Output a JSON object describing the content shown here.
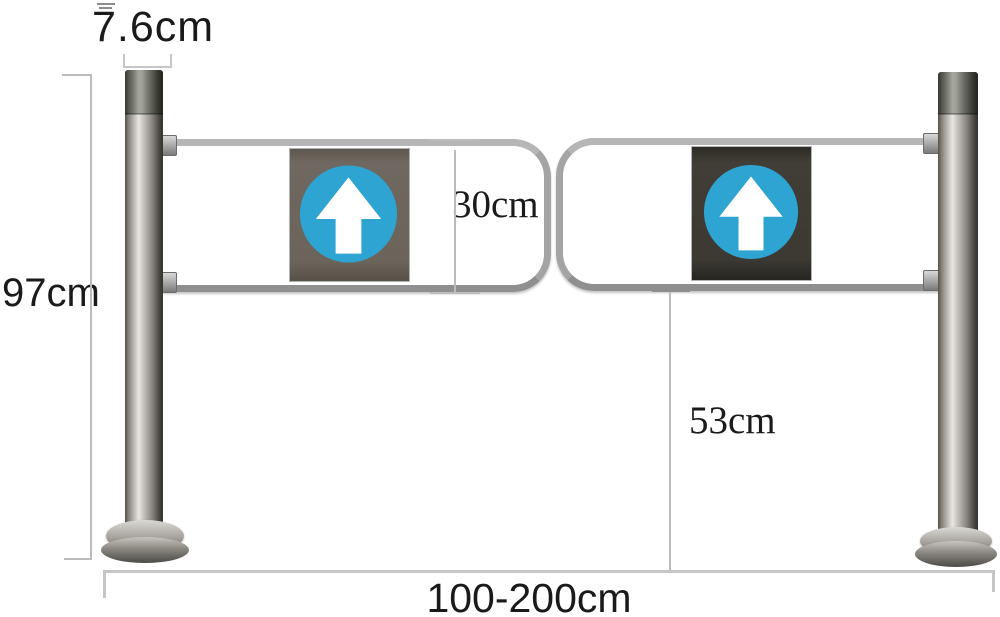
{
  "scene": {
    "description": "Stainless steel supermarket swing gate barrier with two round posts, two tubular swing arms and blue up-arrow sign panels, annotated with dimension lines",
    "background": "#ffffff"
  },
  "dimensions": {
    "post_diameter": "7.6cm",
    "overall_height": "97cm",
    "gate_panel_height": "30cm",
    "ground_clearance": "53cm",
    "width_range": "100-200cm"
  },
  "signs": {
    "left": {
      "icon": "up-arrow-icon",
      "panel_color": "#6b645a",
      "circle_color": "#2ea4d3",
      "arrow_color": "#ffffff"
    },
    "right": {
      "icon": "up-arrow-icon",
      "panel_color": "#3b3932",
      "circle_color": "#2ea4d3",
      "arrow_color": "#ffffff"
    }
  },
  "colors": {
    "dimension_line": "#bcbcbc",
    "label_text": "#1a1a1a",
    "steel_tube": "#a4a4a4",
    "steel_post_highlight": "#e9e7e3"
  }
}
